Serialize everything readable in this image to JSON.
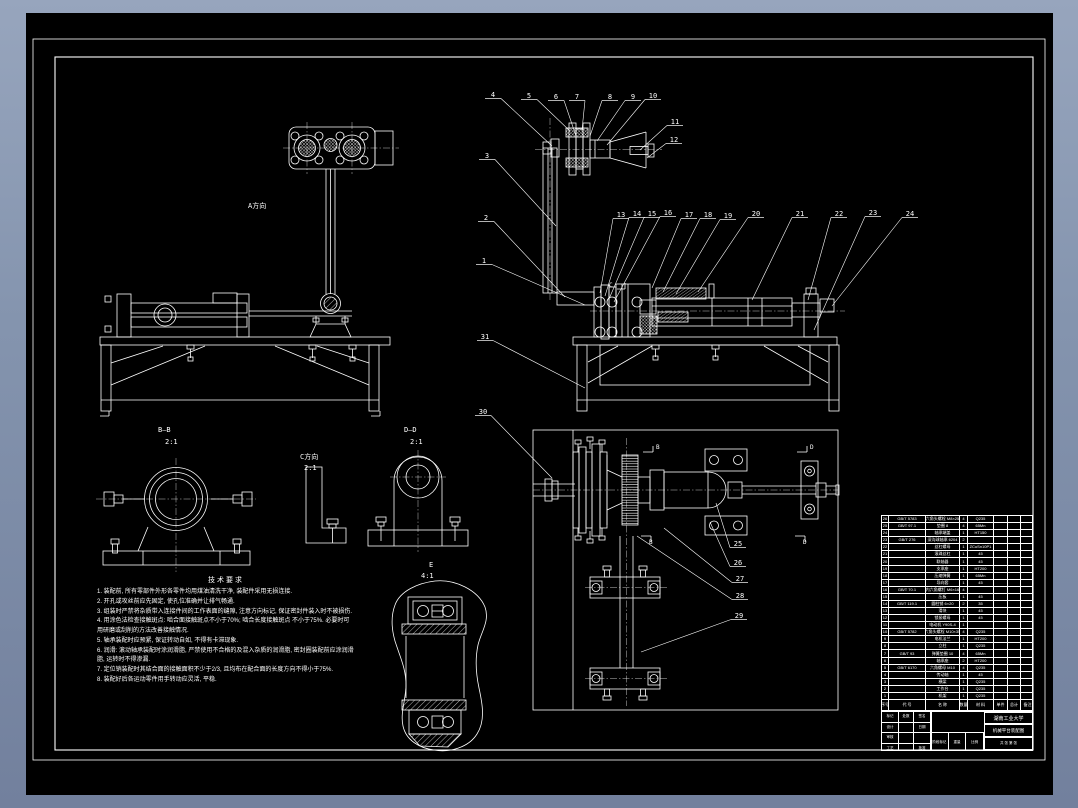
{
  "colors": {
    "background_top": "#97a5bd",
    "background_bottom": "#72809d",
    "sheet": "#000000",
    "line": "#ffffff"
  },
  "callouts": [
    {
      "n": "1",
      "x": 479,
      "y": 261,
      "tx": 585,
      "ty": 305
    },
    {
      "n": "2",
      "x": 481,
      "y": 218,
      "tx": 565,
      "ty": 297
    },
    {
      "n": "3",
      "x": 482,
      "y": 156,
      "tx": 556,
      "ty": 226
    },
    {
      "n": "4",
      "x": 488,
      "y": 95,
      "tx": 552,
      "ty": 146
    },
    {
      "n": "5",
      "x": 524,
      "y": 96,
      "tx": 570,
      "ty": 131
    },
    {
      "n": "6",
      "x": 551,
      "y": 97,
      "tx": 576,
      "ty": 136
    },
    {
      "n": "7",
      "x": 572,
      "y": 97,
      "tx": 582,
      "ty": 130
    },
    {
      "n": "8",
      "x": 605,
      "y": 97,
      "tx": 590,
      "ty": 136
    },
    {
      "n": "9",
      "x": 628,
      "y": 97,
      "tx": 597,
      "ty": 141
    },
    {
      "n": "10",
      "x": 648,
      "y": 96,
      "tx": 607,
      "ty": 145
    },
    {
      "n": "11",
      "x": 670,
      "y": 122,
      "tx": 640,
      "ty": 150
    },
    {
      "n": "12",
      "x": 669,
      "y": 140,
      "tx": 647,
      "ty": 158
    },
    {
      "n": "13",
      "x": 616,
      "y": 215,
      "tx": 600,
      "ty": 293
    },
    {
      "n": "14",
      "x": 632,
      "y": 214,
      "tx": 605,
      "ty": 296
    },
    {
      "n": "15",
      "x": 647,
      "y": 214,
      "tx": 609,
      "ty": 299
    },
    {
      "n": "16",
      "x": 663,
      "y": 213,
      "tx": 614,
      "ty": 302
    },
    {
      "n": "17",
      "x": 684,
      "y": 215,
      "tx": 652,
      "ty": 288
    },
    {
      "n": "18",
      "x": 703,
      "y": 215,
      "tx": 663,
      "ty": 292
    },
    {
      "n": "19",
      "x": 723,
      "y": 216,
      "tx": 676,
      "ty": 294
    },
    {
      "n": "20",
      "x": 751,
      "y": 214,
      "tx": 698,
      "ty": 292
    },
    {
      "n": "21",
      "x": 795,
      "y": 214,
      "tx": 752,
      "ty": 300
    },
    {
      "n": "22",
      "x": 834,
      "y": 214,
      "tx": 808,
      "ty": 300
    },
    {
      "n": "23",
      "x": 868,
      "y": 213,
      "tx": 814,
      "ty": 330
    },
    {
      "n": "24",
      "x": 905,
      "y": 214,
      "tx": 832,
      "ty": 306
    },
    {
      "n": "25",
      "x": 733,
      "y": 544,
      "tx": 716,
      "ty": 503
    },
    {
      "n": "26",
      "x": 733,
      "y": 563,
      "tx": 710,
      "ty": 522
    },
    {
      "n": "27",
      "x": 735,
      "y": 579,
      "tx": 664,
      "ty": 528
    },
    {
      "n": "28",
      "x": 735,
      "y": 596,
      "tx": 637,
      "ty": 536
    },
    {
      "n": "29",
      "x": 734,
      "y": 616,
      "tx": 641,
      "ty": 652
    },
    {
      "n": "30",
      "x": 478,
      "y": 412,
      "tx": 552,
      "ty": 478
    },
    {
      "n": "31",
      "x": 480,
      "y": 337,
      "tx": 585,
      "ty": 388
    }
  ],
  "view_labels": [
    {
      "t": "A方向",
      "x": 248,
      "y": 208,
      "s": 7
    },
    {
      "t": "B—B",
      "x": 158,
      "y": 432,
      "s": 7
    },
    {
      "t": "2:1",
      "x": 165,
      "y": 444,
      "s": 7
    },
    {
      "t": "C方向",
      "x": 300,
      "y": 459,
      "s": 7
    },
    {
      "t": "2:1",
      "x": 304,
      "y": 470,
      "s": 7
    },
    {
      "t": "D—D",
      "x": 404,
      "y": 432,
      "s": 7
    },
    {
      "t": "2:1",
      "x": 410,
      "y": 444,
      "s": 7
    },
    {
      "t": "E",
      "x": 429,
      "y": 567,
      "s": 7
    },
    {
      "t": "4:1",
      "x": 421,
      "y": 578,
      "s": 7
    },
    {
      "t": "B",
      "x": 656,
      "y": 449,
      "s": 6
    },
    {
      "t": "B",
      "x": 649,
      "y": 544,
      "s": 6
    },
    {
      "t": "D",
      "x": 810,
      "y": 449,
      "s": 6
    },
    {
      "t": "D",
      "x": 803,
      "y": 544,
      "s": 6
    },
    {
      "t": "C",
      "x": 609,
      "y": 287,
      "s": 6
    }
  ],
  "technical_requirements": {
    "title": "技术要求",
    "items": [
      "装配前, 所有零部件外形各零件均用煤油清洗干净, 装配件采用无损连接.",
      "开孔或攻丝前应先固定, 使孔位准确并让排气畅通.",
      "组装时严禁将杂质带入连接件间的工作表面的缝隙, 注意方向标记, 保证密封件装入时不被损伤.",
      "用涂色法检查接触斑点: 啮合面接触斑点不小于70%; 啮合长度接触斑点 不小于75%. 必要时可用研磨或刮削的方法改善接触情况.",
      "轴承装配时应预紧, 保证转动自如, 不得有卡滞现象.",
      "润滑: 滚动轴承装配时涂润滑脂, 严禁使用不合格的及混入杂质的润滑脂, 密封圈装配前应涂润滑脂, 运转时不得渗漏.",
      "定位销装配时其结合面的接触面积不少于2/3, 且均布在配合面的长度方向不得小于75%.",
      "装配好后各运动零件用手转动应灵活, 平稳."
    ]
  },
  "bom": {
    "headers": [
      "序号",
      "代 号",
      "名 称",
      "数量",
      "材 料",
      "单件",
      "总计",
      "备注"
    ],
    "col_widths": [
      7,
      37,
      34,
      8,
      26,
      14,
      13,
      13
    ],
    "rows": [
      [
        "26",
        "GB/T 5783",
        "六角头螺栓 M8×25",
        "4",
        "Q235",
        "",
        "",
        ""
      ],
      [
        "25",
        "GB/T 97.1",
        "垫圈 8",
        "4",
        "65Mn",
        "",
        "",
        ""
      ],
      [
        "24",
        "",
        "轴承端盖",
        "1",
        "HT150",
        "",
        "",
        ""
      ],
      [
        "23",
        "GB/T 276",
        "深沟球轴承 6204",
        "2",
        "",
        "",
        "",
        ""
      ],
      [
        "22",
        "",
        "丝杠螺母",
        "1",
        "ZCuSn10P1",
        "",
        "",
        ""
      ],
      [
        "21",
        "",
        "滚珠丝杠",
        "1",
        "45",
        "",
        "",
        ""
      ],
      [
        "20",
        "",
        "联轴器",
        "1",
        "45",
        "",
        "",
        ""
      ],
      [
        "19",
        "",
        "支承座",
        "1",
        "HT200",
        "",
        "",
        ""
      ],
      [
        "18",
        "",
        "压缩弹簧",
        "1",
        "65Mn",
        "",
        "",
        ""
      ],
      [
        "17",
        "",
        "导向套",
        "1",
        "45",
        "",
        "",
        ""
      ],
      [
        "16",
        "GB/T 70.1",
        "内六角螺钉 M6×16",
        "4",
        "",
        "",
        "",
        ""
      ],
      [
        "15",
        "",
        "压板",
        "1",
        "45",
        "",
        "",
        ""
      ],
      [
        "14",
        "GB/T 119.1",
        "圆柱销 6×20",
        "2",
        "35",
        "",
        "",
        ""
      ],
      [
        "13",
        "",
        "滑块",
        "1",
        "45",
        "",
        "",
        ""
      ],
      [
        "12",
        "",
        "锁紧螺母",
        "1",
        "45",
        "",
        "",
        ""
      ],
      [
        "11",
        "",
        "电动机 Y90S-4",
        "1",
        "",
        "",
        "",
        ""
      ],
      [
        "10",
        "GB/T 5782",
        "六角头螺栓 M10×35",
        "4",
        "Q235",
        "",
        "",
        ""
      ],
      [
        "9",
        "",
        "电机法兰",
        "1",
        "HT200",
        "",
        "",
        ""
      ],
      [
        "8",
        "",
        "立柱",
        "1",
        "Q235",
        "",
        "",
        ""
      ],
      [
        "7",
        "GB/T 93",
        "弹簧垫圈 10",
        "4",
        "65Mn",
        "",
        "",
        ""
      ],
      [
        "6",
        "",
        "轴承座",
        "2",
        "HT200",
        "",
        "",
        ""
      ],
      [
        "5",
        "GB/T 6170",
        "六角螺母 M10",
        "4",
        "Q235",
        "",
        "",
        ""
      ],
      [
        "4",
        "",
        "传动轴",
        "1",
        "45",
        "",
        "",
        ""
      ],
      [
        "3",
        "",
        "横梁",
        "1",
        "Q235",
        "",
        "",
        ""
      ],
      [
        "2",
        "",
        "工作台",
        "1",
        "Q235",
        "",
        "",
        ""
      ],
      [
        "1",
        "",
        "机架",
        "1",
        "Q235",
        "",
        "",
        ""
      ]
    ]
  },
  "title_block": {
    "school": "湖南工业大学",
    "drawing_title": "机械平台装配图",
    "left_rows": [
      [
        "标记",
        "处数",
        "签名"
      ],
      [
        "设计",
        "",
        "日期"
      ],
      [
        "审核",
        "",
        ""
      ],
      [
        "工艺",
        "",
        "批准"
      ]
    ],
    "stage_labels": [
      "阶段标记",
      "重量",
      "比例"
    ],
    "sheet_note": "共 张 第 张"
  }
}
